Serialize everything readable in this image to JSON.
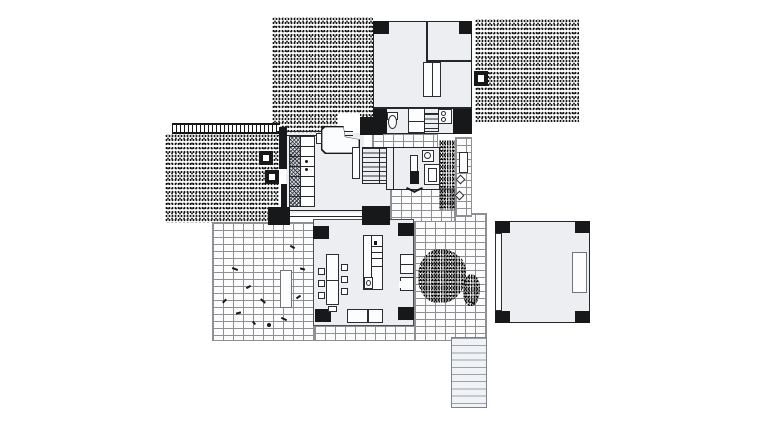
{
  "meta": {
    "description": "modernist-house-ground-floor-plan",
    "canvas": {
      "width": 760,
      "height": 422
    },
    "colors": {
      "paper": "#ffffff",
      "ink": "#17181a",
      "room_fill": "#eceef1",
      "brick_mortar": "#8e9094",
      "stair_tread_light": "#9aa2ac",
      "stipple_dot": "#161616"
    }
  },
  "plan": {
    "regions": [
      {
        "n": "garden-stipple-top-left",
        "c": "stipple",
        "x": 272,
        "y": 17,
        "w": 101,
        "h": 116
      },
      {
        "n": "stipple-mask-entry",
        "c": "whitepatch",
        "x": 338,
        "y": 114,
        "w": 22,
        "h": 19
      },
      {
        "n": "garden-stipple-top-right",
        "c": "stipple",
        "x": 475,
        "y": 19,
        "w": 104,
        "h": 103
      },
      {
        "n": "garden-stipple-left",
        "c": "stipple",
        "x": 165,
        "y": 134,
        "w": 114,
        "h": 89
      },
      {
        "n": "pergola-trellis",
        "c": "trellis",
        "x": 172,
        "y": 123,
        "w": 108,
        "h": 11
      },
      {
        "n": "terrace-brick-left",
        "c": "brick",
        "x": 212,
        "y": 222,
        "w": 102,
        "h": 119
      },
      {
        "n": "terrace-brick-south-strip",
        "c": "brick",
        "x": 314,
        "y": 325,
        "w": 173,
        "h": 16
      },
      {
        "n": "courtyard-brick-east",
        "c": "brick",
        "x": 414,
        "y": 213,
        "w": 73,
        "h": 128
      },
      {
        "n": "passage-brick-south",
        "c": "brick",
        "x": 390,
        "y": 188,
        "w": 65,
        "h": 34
      },
      {
        "n": "path-brick-east-strip",
        "c": "brick",
        "x": 455,
        "y": 137,
        "w": 17,
        "h": 80
      },
      {
        "n": "path-brick-north-strip",
        "c": "brick",
        "x": 372,
        "y": 133,
        "w": 66,
        "h": 15
      },
      {
        "n": "planting-strip",
        "c": "stipple-dense",
        "x": 439,
        "y": 140,
        "w": 16,
        "h": 70
      },
      {
        "n": "shrub-patch-large",
        "c": "stipple-dense blob",
        "x": 418,
        "y": 249,
        "w": 48,
        "h": 54
      },
      {
        "n": "shrub-patch-small",
        "c": "stipple-dense blob",
        "x": 463,
        "y": 274,
        "w": 17,
        "h": 32
      },
      {
        "n": "room-top-block",
        "c": "room",
        "x": 373,
        "y": 21,
        "w": 99,
        "h": 113
      },
      {
        "n": "room-main-band",
        "c": "room noborder",
        "x": 286,
        "y": 133,
        "w": 78,
        "h": 80
      },
      {
        "n": "room-band-corridor",
        "c": "room noborder",
        "x": 362,
        "y": 183,
        "w": 28,
        "h": 25
      },
      {
        "n": "room-bedroom",
        "c": "room",
        "x": 386,
        "y": 147,
        "w": 54,
        "h": 43
      },
      {
        "n": "room-living",
        "c": "room thinborder",
        "x": 313,
        "y": 219,
        "w": 101,
        "h": 107
      },
      {
        "n": "room-east-pavilion",
        "c": "room",
        "x": 495,
        "y": 221,
        "w": 95,
        "h": 102
      },
      {
        "n": "pillar",
        "c": "wall",
        "x": 373,
        "y": 21,
        "w": 16,
        "h": 13
      },
      {
        "n": "pillar",
        "c": "wall",
        "x": 459,
        "y": 21,
        "w": 13,
        "h": 13
      },
      {
        "n": "chimney",
        "c": "wall",
        "x": 474,
        "y": 71,
        "w": 14,
        "h": 15
      },
      {
        "n": "chimney-flue",
        "c": "whitepatch",
        "x": 478,
        "y": 75,
        "w": 6,
        "h": 7
      },
      {
        "n": "wall-bath-west",
        "c": "wall",
        "x": 373,
        "y": 108,
        "w": 14,
        "h": 26
      },
      {
        "n": "wall-bath-east",
        "c": "wall",
        "x": 453,
        "y": 108,
        "w": 19,
        "h": 26
      },
      {
        "n": "wall-junction-block",
        "c": "wall",
        "x": 360,
        "y": 117,
        "w": 23,
        "h": 18
      },
      {
        "n": "wall-band-north-outer",
        "c": "line",
        "x": 277,
        "y": 131,
        "w": 76,
        "h": 1
      },
      {
        "n": "wall-band-north-inner",
        "c": "line",
        "x": 277,
        "y": 135,
        "w": 76,
        "h": 1
      },
      {
        "n": "wall-band-west-upper",
        "c": "wall",
        "x": 279,
        "y": 127,
        "w": 8,
        "h": 42
      },
      {
        "n": "wall-band-west-lower",
        "c": "wall",
        "x": 281,
        "y": 184,
        "w": 6,
        "h": 31
      },
      {
        "n": "planter-column",
        "c": "wall",
        "x": 259,
        "y": 151,
        "w": 14,
        "h": 14
      },
      {
        "n": "planter-column-core",
        "c": "whitepatch",
        "x": 263,
        "y": 155,
        "w": 6,
        "h": 6
      },
      {
        "n": "planter-column",
        "c": "wall",
        "x": 265,
        "y": 170,
        "w": 14,
        "h": 14
      },
      {
        "n": "planter-column-core",
        "c": "whitepatch",
        "x": 269,
        "y": 174,
        "w": 6,
        "h": 6
      },
      {
        "n": "wall-band-south-outer",
        "c": "line",
        "x": 288,
        "y": 210,
        "w": 76,
        "h": 1
      },
      {
        "n": "wall-band-south-inner",
        "c": "line",
        "x": 288,
        "y": 216,
        "w": 76,
        "h": 1
      },
      {
        "n": "pillar",
        "c": "wall",
        "x": 268,
        "y": 207,
        "w": 22,
        "h": 18
      },
      {
        "n": "pillar",
        "c": "wall",
        "x": 362,
        "y": 206,
        "w": 28,
        "h": 19
      },
      {
        "n": "pillar",
        "c": "wall",
        "x": 313,
        "y": 226,
        "w": 16,
        "h": 13
      },
      {
        "n": "pillar",
        "c": "wall",
        "x": 398,
        "y": 223,
        "w": 16,
        "h": 13
      },
      {
        "n": "pillar",
        "c": "wall",
        "x": 315,
        "y": 309,
        "w": 16,
        "h": 13
      },
      {
        "n": "pillar",
        "c": "wall",
        "x": 398,
        "y": 307,
        "w": 16,
        "h": 13
      },
      {
        "n": "pillar",
        "c": "wall",
        "x": 495,
        "y": 221,
        "w": 15,
        "h": 12
      },
      {
        "n": "pillar",
        "c": "wall",
        "x": 575,
        "y": 221,
        "w": 15,
        "h": 12
      },
      {
        "n": "pillar",
        "c": "wall",
        "x": 495,
        "y": 311,
        "w": 15,
        "h": 12
      },
      {
        "n": "pillar",
        "c": "wall",
        "x": 575,
        "y": 311,
        "w": 15,
        "h": 12
      },
      {
        "n": "wall-top-room-divider-v",
        "c": "line",
        "x": 426,
        "y": 21,
        "w": 2,
        "h": 41
      },
      {
        "n": "wall-top-room-divider-h",
        "c": "line",
        "x": 426,
        "y": 60,
        "w": 46,
        "h": 2
      },
      {
        "n": "wall-bath-north",
        "c": "line",
        "x": 373,
        "y": 107,
        "w": 99,
        "h": 2
      },
      {
        "n": "wall-bedroom-divider",
        "c": "line",
        "x": 393,
        "y": 147,
        "w": 1,
        "h": 43
      },
      {
        "n": "wardrobe",
        "c": "furn split-v",
        "x": 423,
        "y": 62,
        "w": 18,
        "h": 35
      },
      {
        "n": "toilet-tank",
        "c": "furn",
        "x": 387,
        "y": 112,
        "w": 11,
        "h": 8
      },
      {
        "n": "toilet-bowl",
        "c": "furn oval",
        "x": 388,
        "y": 115,
        "w": 9,
        "h": 14
      },
      {
        "n": "bath-cabinet",
        "c": "furn split-h",
        "x": 408,
        "y": 108,
        "w": 17,
        "h": 25
      },
      {
        "n": "bath-stair",
        "c": "treads",
        "x": 424,
        "y": 113,
        "w": 15,
        "h": 19
      },
      {
        "n": "washbasin-unit",
        "c": "furn",
        "x": 438,
        "y": 109,
        "w": 14,
        "h": 15
      },
      {
        "n": "washbasin-bowl",
        "c": "furn oval",
        "x": 441,
        "y": 111,
        "w": 5,
        "h": 5
      },
      {
        "n": "washbasin-bowl",
        "c": "furn oval",
        "x": 441,
        "y": 117,
        "w": 5,
        "h": 5
      },
      {
        "n": "kitchen-counter",
        "c": "furn",
        "x": 289,
        "y": 136,
        "w": 26,
        "h": 71
      },
      {
        "n": "kitchen-hatch-column",
        "c": "hatch",
        "x": 290,
        "y": 137,
        "w": 10,
        "h": 69
      },
      {
        "n": "kitchen-divider",
        "c": "line",
        "x": 300,
        "y": 136,
        "w": 1,
        "h": 71
      },
      {
        "n": "kitchen-shelf-line",
        "c": "line",
        "x": 289,
        "y": 146,
        "w": 26,
        "h": 1
      },
      {
        "n": "kitchen-shelf-line",
        "c": "line",
        "x": 289,
        "y": 156,
        "w": 26,
        "h": 1
      },
      {
        "n": "kitchen-shelf-line",
        "c": "line",
        "x": 289,
        "y": 166,
        "w": 26,
        "h": 1
      },
      {
        "n": "kitchen-shelf-line",
        "c": "line",
        "x": 289,
        "y": 176,
        "w": 26,
        "h": 1
      },
      {
        "n": "kitchen-shelf-line",
        "c": "line",
        "x": 289,
        "y": 186,
        "w": 26,
        "h": 1
      },
      {
        "n": "kitchen-shelf-line",
        "c": "line",
        "x": 289,
        "y": 196,
        "w": 26,
        "h": 1
      },
      {
        "n": "stove-burner",
        "c": "mark oval",
        "x": 305,
        "y": 160,
        "w": 3,
        "h": 3
      },
      {
        "n": "stove-burner",
        "c": "mark oval",
        "x": 305,
        "y": 168,
        "w": 3,
        "h": 3
      },
      {
        "n": "grand-piano",
        "c": "piano",
        "x": 321,
        "y": 126,
        "w": 39,
        "h": 28
      },
      {
        "n": "piano-bench",
        "c": "furn",
        "x": 316,
        "y": 133,
        "w": 6,
        "h": 11
      },
      {
        "n": "hall-door-panel",
        "c": "furn",
        "x": 352,
        "y": 147,
        "w": 8,
        "h": 32
      },
      {
        "n": "stair-main",
        "c": "treads",
        "x": 362,
        "y": 147,
        "w": 25,
        "h": 37
      },
      {
        "n": "stair-stringer",
        "c": "line",
        "x": 379,
        "y": 147,
        "w": 1,
        "h": 37
      },
      {
        "n": "bed",
        "c": "furn",
        "x": 410,
        "y": 155,
        "w": 8,
        "h": 27
      },
      {
        "n": "bed-foot-block",
        "c": "wall",
        "x": 410,
        "y": 171,
        "w": 9,
        "h": 13
      },
      {
        "n": "bath2-basin",
        "c": "furn",
        "x": 422,
        "y": 150,
        "w": 12,
        "h": 12
      },
      {
        "n": "bath2-basin-bowl",
        "c": "furn oval",
        "x": 424,
        "y": 152,
        "w": 7,
        "h": 7
      },
      {
        "n": "shower",
        "c": "furn inset",
        "x": 424,
        "y": 164,
        "w": 16,
        "h": 21
      },
      {
        "n": "door-swing-mark",
        "c": "mark",
        "x": 406,
        "y": 189,
        "w": 10,
        "h": 2,
        "r": 25
      },
      {
        "n": "door-swing-mark",
        "c": "mark",
        "x": 413,
        "y": 189,
        "w": 10,
        "h": 2,
        "r": -25
      },
      {
        "n": "garden-bench",
        "c": "furn",
        "x": 459,
        "y": 152,
        "w": 9,
        "h": 21
      },
      {
        "n": "stepping-stone",
        "c": "furn",
        "x": 457,
        "y": 176,
        "w": 7,
        "h": 7,
        "r": 45
      },
      {
        "n": "stepping-stone",
        "c": "furn",
        "x": 456,
        "y": 192,
        "w": 7,
        "h": 7,
        "r": 45
      },
      {
        "n": "dining-table",
        "c": "furn split-h",
        "x": 326,
        "y": 254,
        "w": 13,
        "h": 51
      },
      {
        "n": "dining-chair",
        "c": "furn",
        "x": 318,
        "y": 268,
        "w": 7,
        "h": 7
      },
      {
        "n": "dining-chair",
        "c": "furn",
        "x": 318,
        "y": 280,
        "w": 7,
        "h": 7
      },
      {
        "n": "dining-chair",
        "c": "furn",
        "x": 318,
        "y": 292,
        "w": 7,
        "h": 7
      },
      {
        "n": "dining-chair",
        "c": "furn",
        "x": 341,
        "y": 264,
        "w": 7,
        "h": 7
      },
      {
        "n": "dining-chair",
        "c": "furn",
        "x": 341,
        "y": 276,
        "w": 7,
        "h": 7
      },
      {
        "n": "dining-chair",
        "c": "furn",
        "x": 341,
        "y": 288,
        "w": 7,
        "h": 7
      },
      {
        "n": "dining-chair",
        "c": "furn",
        "x": 328,
        "y": 306,
        "w": 9,
        "h": 6
      },
      {
        "n": "island-unit",
        "c": "furn",
        "x": 363,
        "y": 235,
        "w": 20,
        "h": 55
      },
      {
        "n": "island-divider",
        "c": "line",
        "x": 371,
        "y": 235,
        "w": 1,
        "h": 44
      },
      {
        "n": "island-shelf-line",
        "c": "line",
        "x": 371,
        "y": 246,
        "w": 12,
        "h": 1
      },
      {
        "n": "island-shelf-line",
        "c": "line",
        "x": 371,
        "y": 252,
        "w": 12,
        "h": 1
      },
      {
        "n": "island-shelf-line",
        "c": "line",
        "x": 371,
        "y": 258,
        "w": 12,
        "h": 1
      },
      {
        "n": "island-shelf-line",
        "c": "line",
        "x": 371,
        "y": 266,
        "w": 12,
        "h": 1
      },
      {
        "n": "island-sink-cell",
        "c": "furn",
        "x": 364,
        "y": 277,
        "w": 9,
        "h": 12
      },
      {
        "n": "island-sink-bowl",
        "c": "furn oval",
        "x": 366,
        "y": 280,
        "w": 5,
        "h": 6
      },
      {
        "n": "island-dot",
        "c": "mark",
        "x": 374,
        "y": 241,
        "w": 3,
        "h": 4
      },
      {
        "n": "shelf-unit-east",
        "c": "furn split-h",
        "x": 400,
        "y": 254,
        "w": 14,
        "h": 20
      },
      {
        "n": "fireplace",
        "c": "furn",
        "x": 400,
        "y": 277,
        "w": 14,
        "h": 14
      },
      {
        "n": "fireplace-opening",
        "c": "whitepatch",
        "x": 399,
        "y": 281,
        "w": 4,
        "h": 7
      },
      {
        "n": "sofa",
        "c": "furn",
        "x": 347,
        "y": 309,
        "w": 21,
        "h": 14
      },
      {
        "n": "sofa",
        "c": "furn",
        "x": 368,
        "y": 309,
        "w": 15,
        "h": 14
      },
      {
        "n": "terrace-planter",
        "c": "furn grayborder",
        "x": 280,
        "y": 270,
        "w": 12,
        "h": 38
      },
      {
        "n": "pavilion-door",
        "c": "furn grayborder",
        "x": 572,
        "y": 252,
        "w": 15,
        "h": 41
      },
      {
        "n": "pavilion-west-wall",
        "c": "furn",
        "x": 495,
        "y": 233,
        "w": 7,
        "h": 78
      },
      {
        "n": "stair-exterior",
        "c": "treads-lg",
        "x": 451,
        "y": 337,
        "w": 36,
        "h": 71
      },
      {
        "n": "plant-mark",
        "c": "mark",
        "x": 232,
        "y": 268,
        "w": 6,
        "h": 2,
        "r": 20
      },
      {
        "n": "plant-mark",
        "c": "mark",
        "x": 246,
        "y": 286,
        "w": 5,
        "h": 2,
        "r": -30
      },
      {
        "n": "plant-mark",
        "c": "mark",
        "x": 260,
        "y": 300,
        "w": 6,
        "h": 2,
        "r": 40
      },
      {
        "n": "plant-mark",
        "c": "mark",
        "x": 236,
        "y": 312,
        "w": 5,
        "h": 2,
        "r": -15
      },
      {
        "n": "plant-mark",
        "c": "mark",
        "x": 281,
        "y": 318,
        "w": 6,
        "h": 2,
        "r": 25
      },
      {
        "n": "plant-mark",
        "c": "mark",
        "x": 296,
        "y": 296,
        "w": 5,
        "h": 2,
        "r": -35
      },
      {
        "n": "plant-mark",
        "c": "mark",
        "x": 300,
        "y": 268,
        "w": 5,
        "h": 2,
        "r": 15
      },
      {
        "n": "plant-mark",
        "c": "mark",
        "x": 252,
        "y": 322,
        "w": 4,
        "h": 2,
        "r": 50
      },
      {
        "n": "plant-mark",
        "c": "mark",
        "x": 222,
        "y": 300,
        "w": 5,
        "h": 2,
        "r": -45
      },
      {
        "n": "plant-mark",
        "c": "mark",
        "x": 290,
        "y": 246,
        "w": 5,
        "h": 2,
        "r": 30
      },
      {
        "n": "plant-mark",
        "c": "mark",
        "x": 470,
        "y": 302,
        "w": 5,
        "h": 2,
        "r": 30
      },
      {
        "n": "terrace-dot",
        "c": "mark oval",
        "x": 267,
        "y": 323,
        "w": 4,
        "h": 4
      }
    ]
  }
}
